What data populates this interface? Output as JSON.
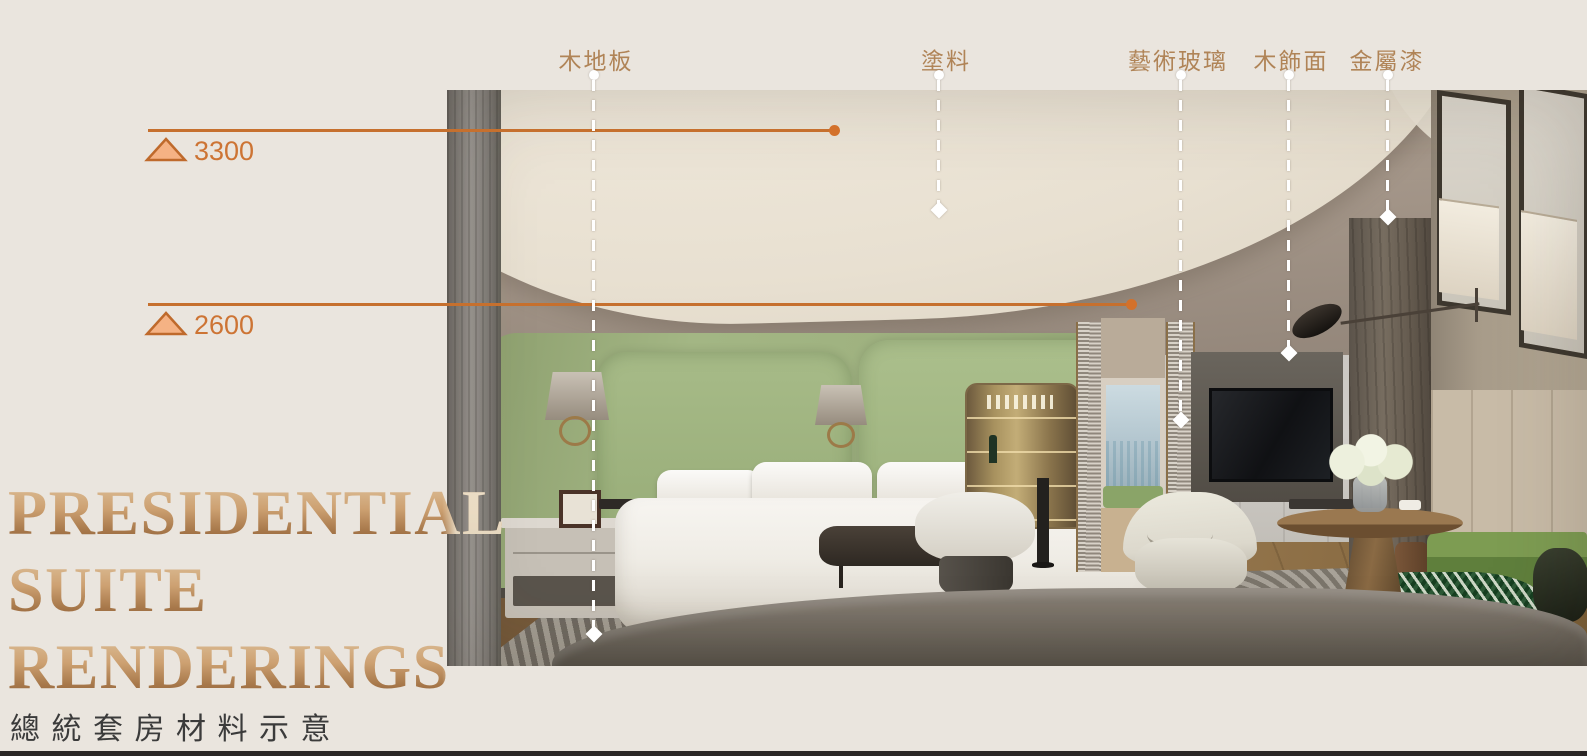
{
  "colors": {
    "background": "#EAE5DE",
    "accent_orange": "#C6702E",
    "triangle_fill": "#F5B284",
    "label_bronze": "#B08457",
    "title_gradient_top": "#E0C5A0",
    "title_gradient_bottom": "#8B5C36",
    "subtitle_text": "#3B3B3B",
    "footer_bar": "#2B2726"
  },
  "title": {
    "line1": "PRESIDENTIAL",
    "line2": "SUITE",
    "line3": "RENDERINGS"
  },
  "subtitle": "總 統 套 房 材 料 示 意",
  "elevations": [
    {
      "value": "3300"
    },
    {
      "value": "2600"
    }
  ],
  "materials": [
    {
      "label": "木地板"
    },
    {
      "label": "塗料"
    },
    {
      "label": "藝術玻璃"
    },
    {
      "label": "木飾面"
    },
    {
      "label": "金屬漆"
    }
  ]
}
